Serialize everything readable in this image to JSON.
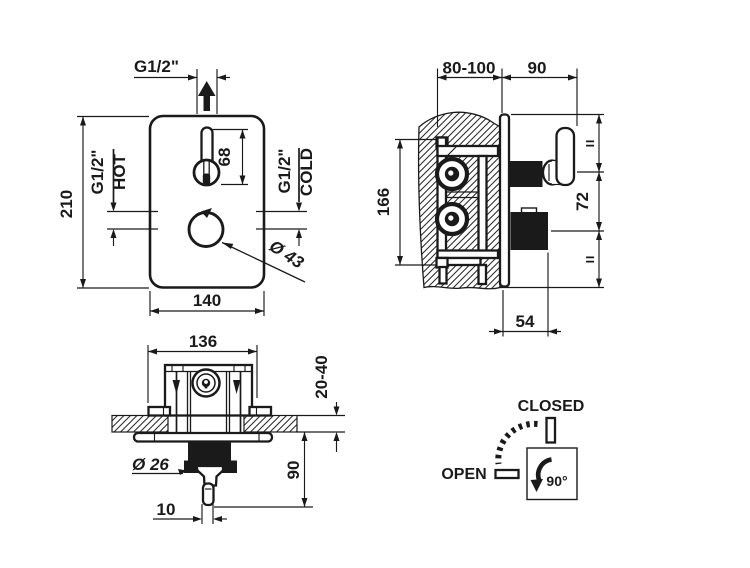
{
  "colors": {
    "ink": "#1a1a1a",
    "background": "#ffffff"
  },
  "front_view": {
    "outlet_thread": "G1/2\"",
    "height": "210",
    "hot_thread": "G1/2\"",
    "hot_label": "HOT",
    "cold_thread": "G1/2\"",
    "cold_label": "COLD",
    "lever_height": "68",
    "knob_diameter": "Ø 43",
    "width": "140"
  },
  "side_view": {
    "wall_depth_range": "80-100",
    "handle_protrusion": "90",
    "body_height": "166",
    "equal_top": "=",
    "handle_spacing": "72",
    "equal_bottom": "=",
    "knob_protrusion": "54"
  },
  "top_view": {
    "body_width": "136",
    "finish_depth_range": "20-40",
    "stem_diameter": "Ø 26",
    "handle_protrusion": "90",
    "lever_tip_width": "10"
  },
  "rotation_diagram": {
    "closed_label": "CLOSED",
    "open_label": "OPEN",
    "rotation_angle": "90°"
  }
}
